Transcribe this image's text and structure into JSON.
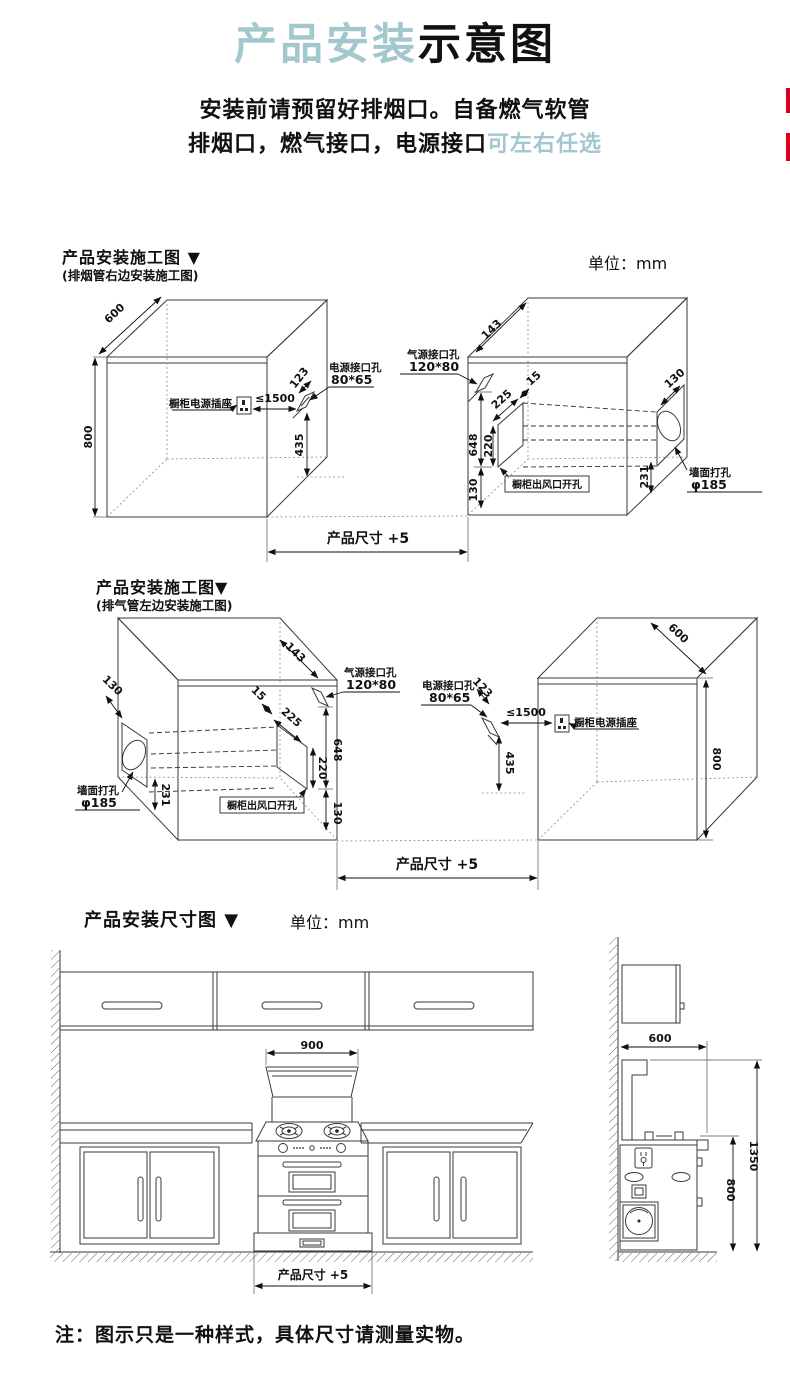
{
  "header": {
    "title_accent": "产品安装",
    "title_main": "示意图",
    "line1": "安装前请预留好排烟口。自备燃气软管",
    "line2_main": "排烟口，燃气接口，电源接口",
    "line2_accent": "可左右任选"
  },
  "sections": {
    "s1": {
      "title": "产品安装施工图 ▼",
      "subtitle": "(排烟管右边安装施工图)",
      "unit": "单位：mm"
    },
    "s2": {
      "title": "产品安装施工图▼",
      "subtitle": "(排气管左边安装施工图)"
    },
    "s3": {
      "title": "产品安装尺寸图 ▼",
      "unit": "单位：mm"
    }
  },
  "dims": {
    "depth": "600",
    "height": "800",
    "socket_label": "橱柜电源插座",
    "socket_max_distance": "≤1500",
    "power_hole_label": "电源接口孔",
    "power_hole_size": "80*65",
    "power_hole_offset": "123",
    "power_hole_drop": "435",
    "gas_hole_label": "气源接口孔",
    "gas_hole_size": "120*80",
    "gas_hole_offset": "143",
    "vent_inset": "15",
    "vent_width": "225",
    "vent_drop_total": "648",
    "vent_height": "220",
    "vent_bottom_offset": "130",
    "wall_hole_offset": "130",
    "wall_hole_drop": "231",
    "wall_hole_label": "墙面打孔",
    "wall_hole_size": "φ185",
    "vent_cutout_label": "橱柜出风口开孔",
    "product_width_label": "产品尺寸 +5"
  },
  "size_diagram": {
    "stove_width": "900",
    "product_width_label": "产品尺寸 +5",
    "counter_depth": "600",
    "counter_height": "800",
    "total_height": "1350"
  },
  "footer": {
    "note": "注：图示只是一种样式，具体尺寸请测量实物。"
  },
  "colors": {
    "accent": "#a2c7cd",
    "marker_red": "#d9001b"
  }
}
